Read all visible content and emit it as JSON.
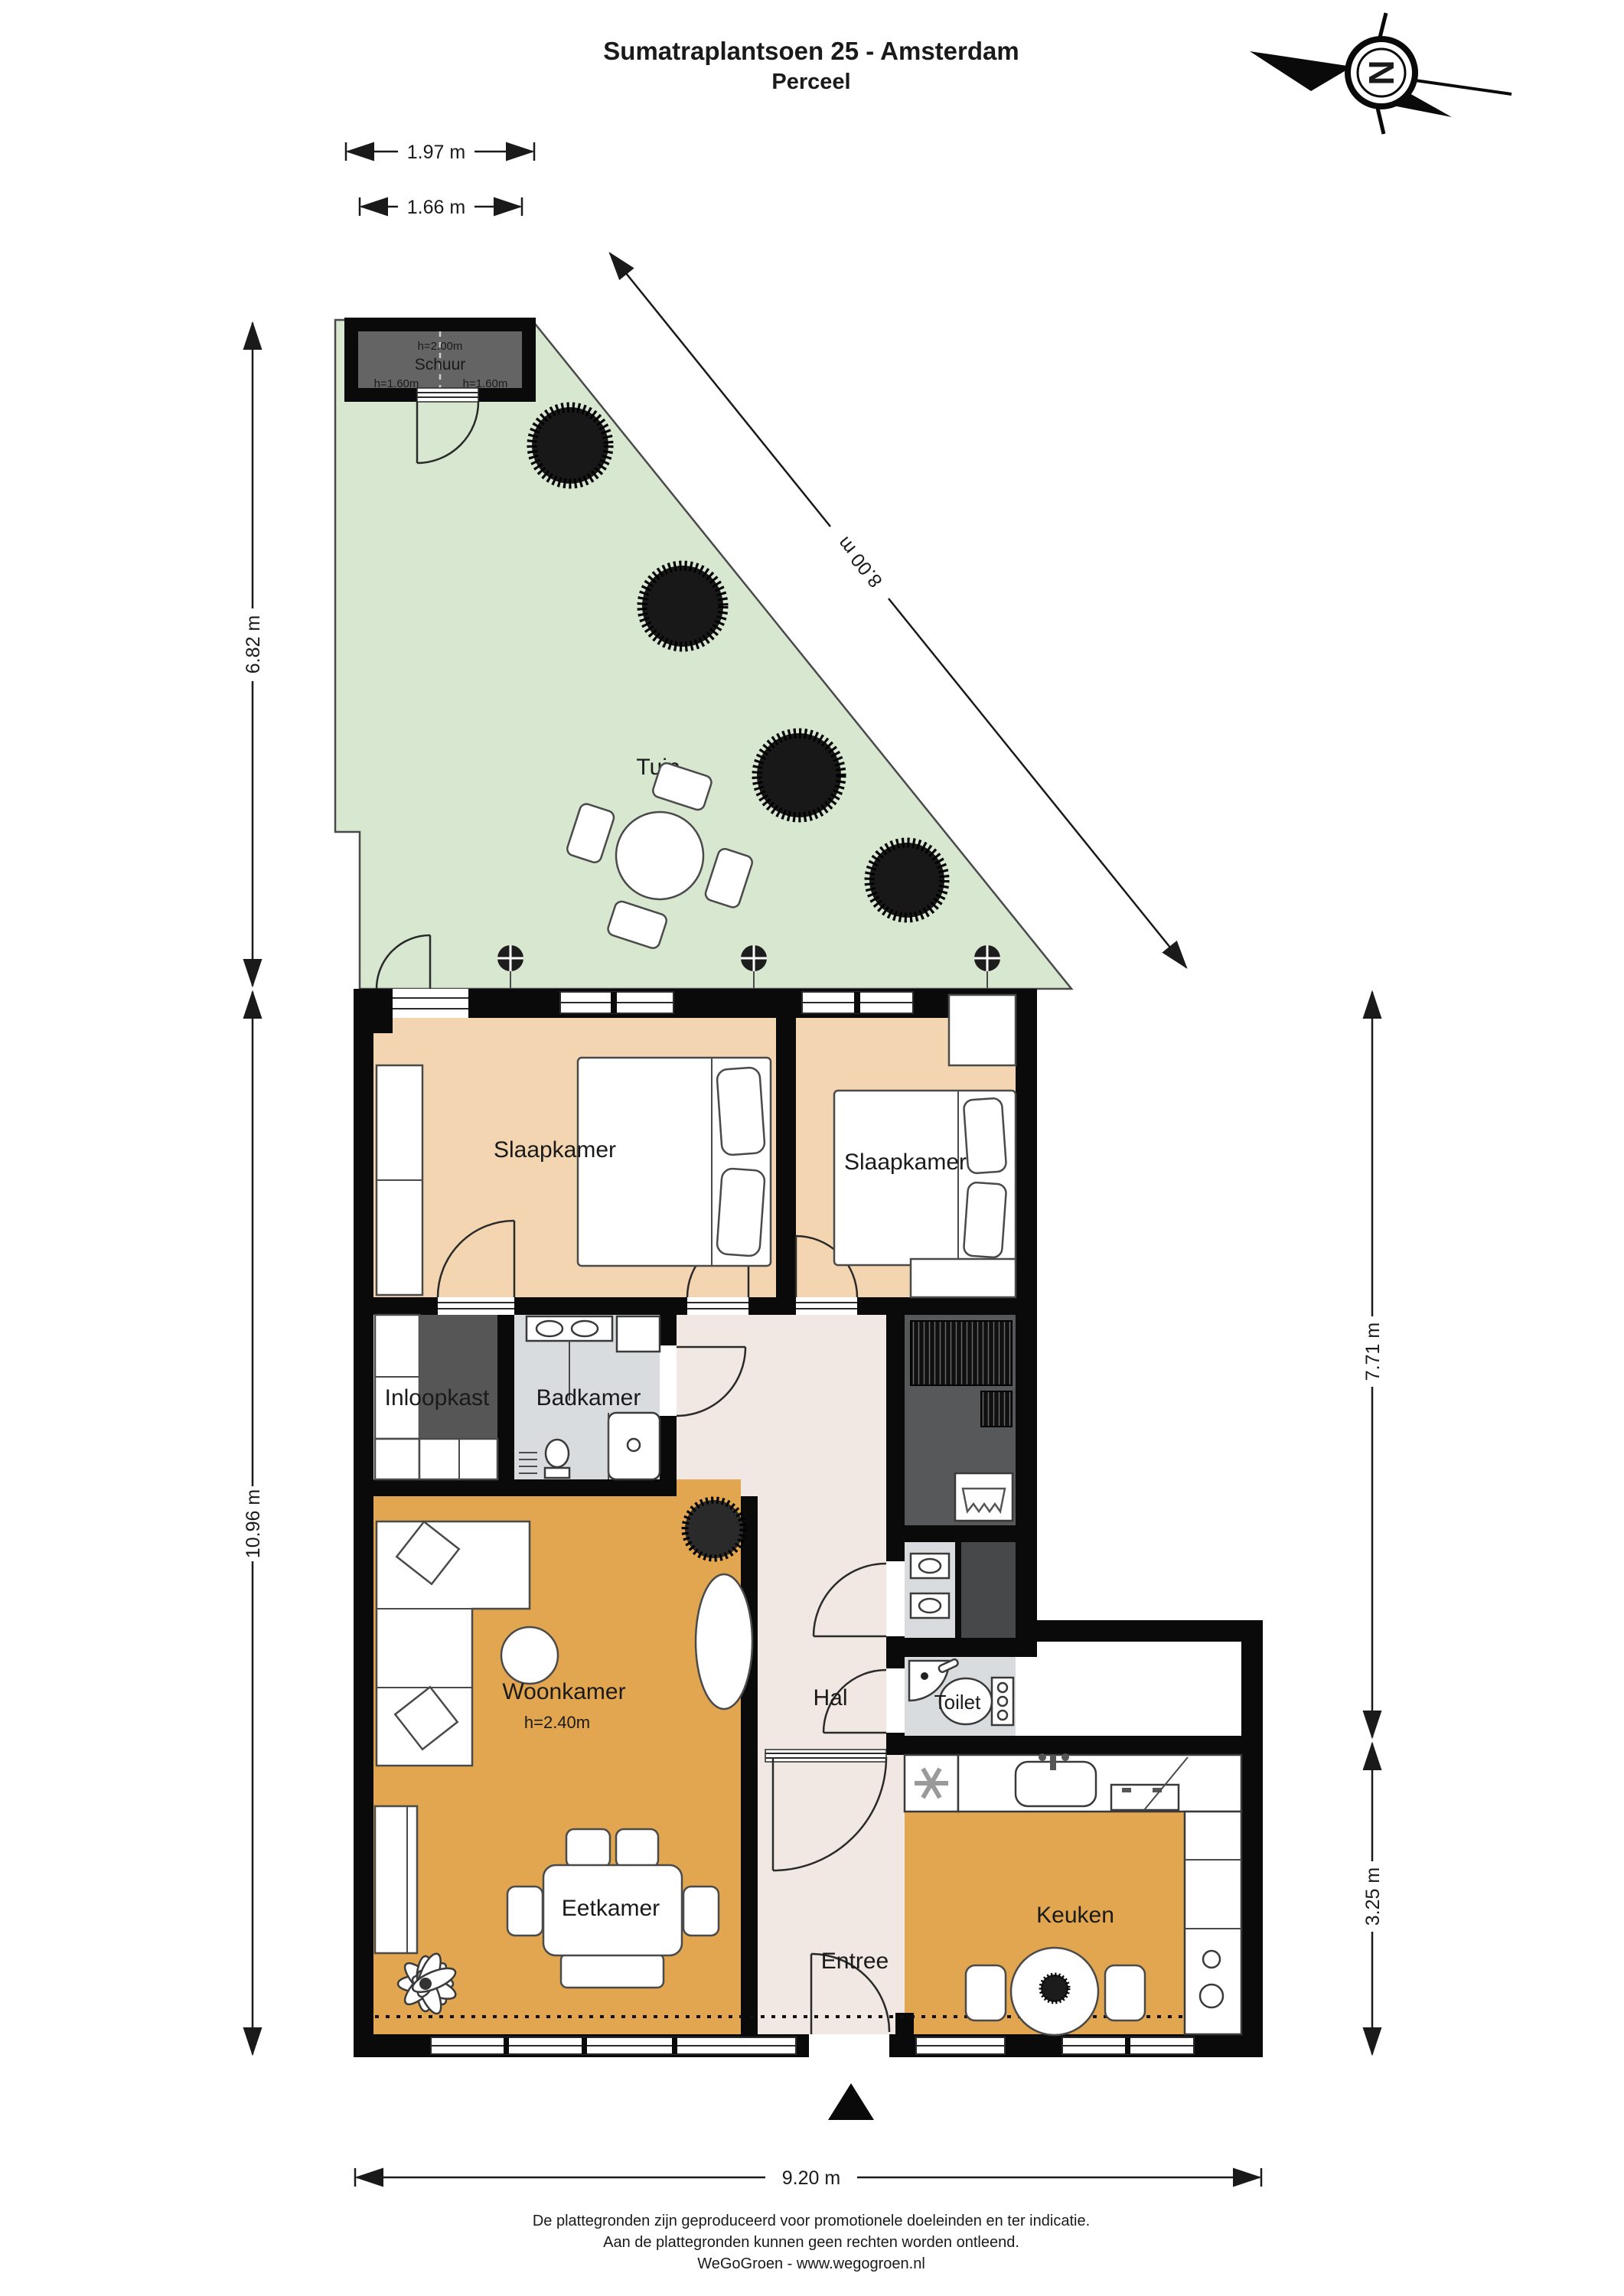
{
  "title": {
    "line1": "Sumatraplantsoen 25 - Amsterdam",
    "line2": "Perceel"
  },
  "compass": {
    "north_letter": "N"
  },
  "rooms": {
    "tuin": "Tuin",
    "schuur": "Schuur",
    "slaapkamer1": "Slaapkamer",
    "slaapkamer2": "Slaapkamer",
    "inloopkast": "Inloopkast",
    "badkamer": "Badkamer",
    "hal": "Hal",
    "woonkamer": "Woonkamer",
    "toilet": "Toilet",
    "eetkamer": "Eetkamer",
    "entree": "Entree",
    "keuken": "Keuken"
  },
  "heights": {
    "schuur_top": "h=2.00m",
    "schuur_left": "h=1.60m",
    "schuur_right": "h=1.60m",
    "woonkamer": "h=2.40m"
  },
  "dimensions": {
    "top_outer": "1.97 m",
    "top_inner": "1.66 m",
    "garden_left": "6.82 m",
    "house_left": "10.96 m",
    "garden_diagonal": "8.00 m",
    "house_right_upper": "7.71 m",
    "house_right_lower": "3.25 m",
    "house_bottom": "9.20 m"
  },
  "footer": {
    "line1": "De plattegronden zijn geproduceerd voor promotionele doeleinden en ter indicatie.",
    "line2": "Aan de plattegronden kunnen geen rechten worden ontleend.",
    "line3": "WeGoGroen -  www.wegogroen.nl"
  },
  "colors": {
    "wall": "#0a0a0a",
    "garden": "#d8e7cf",
    "bedroom": "#f3d6b1",
    "living": "#e1a64f",
    "hall": "#f1e8e3",
    "bath": "#d9dcde",
    "utility": "#57585a",
    "dark_cell": "#47484a",
    "schuur_floor": "#646464",
    "wardrobe": "#565656",
    "tree": "#181818"
  }
}
